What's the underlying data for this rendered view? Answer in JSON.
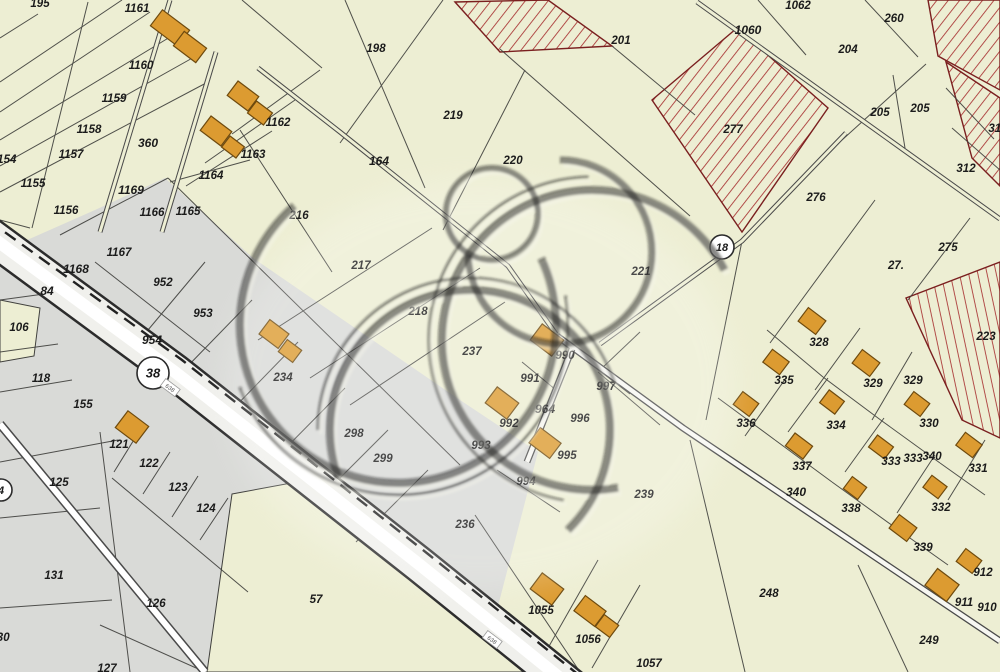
{
  "meta": {
    "kind": "cadastral-parcel-map",
    "width": 1000,
    "height": 672
  },
  "colors": {
    "background": "#edeed3",
    "gray_zone": "#d9dad7",
    "parcel_line": "#3f3f3c",
    "building_fill": "#dc9b31",
    "building_stroke": "#6e4a0e",
    "hatch_line": "#a83232",
    "hatch_border": "#7a1f1f",
    "road_fill": "#f0f0ec",
    "road_edge": "#2c2c2c",
    "road_center": "#ffffff",
    "label": "#1b1b1b",
    "badge_fill": "#ffffff",
    "badge_stroke": "#2b2b2b",
    "watermark": "#1c1c1c"
  },
  "badges": [
    {
      "t": "38",
      "x": 153,
      "y": 373,
      "r": 16
    },
    {
      "t": "18",
      "x": 722,
      "y": 247,
      "r": 12
    },
    {
      "t": "4",
      "x": 1,
      "y": 490,
      "r": 11
    }
  ],
  "road_tags": [
    {
      "t": "638",
      "x": 170,
      "y": 388
    },
    {
      "t": "638",
      "x": 492,
      "y": 640
    }
  ],
  "labels": [
    {
      "t": "195",
      "x": 40,
      "y": 4
    },
    {
      "t": "1161",
      "x": 137,
      "y": 9
    },
    {
      "t": "1160",
      "x": 141,
      "y": 66
    },
    {
      "t": "1159",
      "x": 114,
      "y": 99
    },
    {
      "t": "1158",
      "x": 89,
      "y": 130
    },
    {
      "t": "1157",
      "x": 71,
      "y": 155
    },
    {
      "t": "1154",
      "x": 4,
      "y": 160
    },
    {
      "t": "1155",
      "x": 33,
      "y": 184
    },
    {
      "t": "1156",
      "x": 66,
      "y": 211
    },
    {
      "t": "360",
      "x": 148,
      "y": 144,
      "b": 1
    },
    {
      "t": "1162",
      "x": 278,
      "y": 123
    },
    {
      "t": "1163",
      "x": 253,
      "y": 155
    },
    {
      "t": "1164",
      "x": 211,
      "y": 176
    },
    {
      "t": "1169",
      "x": 131,
      "y": 191,
      "b": 1
    },
    {
      "t": "1166",
      "x": 152,
      "y": 213
    },
    {
      "t": "1165",
      "x": 188,
      "y": 212
    },
    {
      "t": "1167",
      "x": 119,
      "y": 253
    },
    {
      "t": "1168",
      "x": 76,
      "y": 270,
      "b": 1
    },
    {
      "t": "84",
      "x": 47,
      "y": 292,
      "b": 1
    },
    {
      "t": "952",
      "x": 163,
      "y": 283
    },
    {
      "t": "953",
      "x": 203,
      "y": 314
    },
    {
      "t": "954",
      "x": 152,
      "y": 341,
      "b": 1
    },
    {
      "t": "106",
      "x": 19,
      "y": 328
    },
    {
      "t": "118",
      "x": 41,
      "y": 379
    },
    {
      "t": "155",
      "x": 83,
      "y": 405
    },
    {
      "t": "121",
      "x": 119,
      "y": 445
    },
    {
      "t": "122",
      "x": 149,
      "y": 464
    },
    {
      "t": "125",
      "x": 59,
      "y": 483
    },
    {
      "t": "123",
      "x": 178,
      "y": 488
    },
    {
      "t": "124",
      "x": 206,
      "y": 509
    },
    {
      "t": "131",
      "x": 54,
      "y": 576
    },
    {
      "t": "126",
      "x": 156,
      "y": 604
    },
    {
      "t": "127",
      "x": 107,
      "y": 669
    },
    {
      "t": "130",
      "x": 0,
      "y": 638
    },
    {
      "t": "57",
      "x": 316,
      "y": 600
    },
    {
      "t": "198",
      "x": 376,
      "y": 49
    },
    {
      "t": "201",
      "x": 621,
      "y": 41
    },
    {
      "t": "219",
      "x": 453,
      "y": 116
    },
    {
      "t": "220",
      "x": 513,
      "y": 161
    },
    {
      "t": "164",
      "x": 379,
      "y": 162,
      "b": 1
    },
    {
      "t": "216",
      "x": 299,
      "y": 216
    },
    {
      "t": "217",
      "x": 361,
      "y": 266
    },
    {
      "t": "218",
      "x": 418,
      "y": 312
    },
    {
      "t": "237",
      "x": 472,
      "y": 352
    },
    {
      "t": "221",
      "x": 641,
      "y": 272
    },
    {
      "t": "1062",
      "x": 798,
      "y": 6
    },
    {
      "t": "260",
      "x": 894,
      "y": 19
    },
    {
      "t": "1060",
      "x": 748,
      "y": 31,
      "b": 1
    },
    {
      "t": "204",
      "x": 848,
      "y": 50
    },
    {
      "t": "205",
      "x": 880,
      "y": 113
    },
    {
      "t": "205",
      "x": 920,
      "y": 109
    },
    {
      "t": "277",
      "x": 733,
      "y": 130
    },
    {
      "t": "276",
      "x": 816,
      "y": 198
    },
    {
      "t": "312",
      "x": 966,
      "y": 169
    },
    {
      "t": "313",
      "x": 998,
      "y": 129
    },
    {
      "t": "275",
      "x": 948,
      "y": 248
    },
    {
      "t": "27.",
      "x": 896,
      "y": 266
    },
    {
      "t": "223",
      "x": 986,
      "y": 337
    },
    {
      "t": "328",
      "x": 819,
      "y": 343
    },
    {
      "t": "335",
      "x": 784,
      "y": 381
    },
    {
      "t": "329",
      "x": 873,
      "y": 384
    },
    {
      "t": "329",
      "x": 913,
      "y": 381
    },
    {
      "t": "336",
      "x": 746,
      "y": 424
    },
    {
      "t": "334",
      "x": 836,
      "y": 426
    },
    {
      "t": "330",
      "x": 929,
      "y": 424
    },
    {
      "t": "337",
      "x": 802,
      "y": 467
    },
    {
      "t": "333",
      "x": 891,
      "y": 462
    },
    {
      "t": "333",
      "x": 913,
      "y": 459
    },
    {
      "t": "340",
      "x": 932,
      "y": 457
    },
    {
      "t": "331",
      "x": 978,
      "y": 469
    },
    {
      "t": "338",
      "x": 851,
      "y": 509
    },
    {
      "t": "332",
      "x": 941,
      "y": 508
    },
    {
      "t": "339",
      "x": 923,
      "y": 548
    },
    {
      "t": "912",
      "x": 983,
      "y": 573
    },
    {
      "t": "911",
      "x": 964,
      "y": 603
    },
    {
      "t": "910",
      "x": 987,
      "y": 608
    },
    {
      "t": "340",
      "x": 796,
      "y": 493,
      "b": 1
    },
    {
      "t": "248",
      "x": 769,
      "y": 594
    },
    {
      "t": "249",
      "x": 929,
      "y": 641
    },
    {
      "t": "239",
      "x": 644,
      "y": 495
    },
    {
      "t": "236",
      "x": 465,
      "y": 525
    },
    {
      "t": "298",
      "x": 354,
      "y": 434
    },
    {
      "t": "299",
      "x": 383,
      "y": 459
    },
    {
      "t": "990",
      "x": 565,
      "y": 356
    },
    {
      "t": "991",
      "x": 530,
      "y": 379
    },
    {
      "t": "997",
      "x": 606,
      "y": 387
    },
    {
      "t": "992",
      "x": 509,
      "y": 424
    },
    {
      "t": "964",
      "x": 545,
      "y": 410,
      "b": 1
    },
    {
      "t": "996",
      "x": 580,
      "y": 419
    },
    {
      "t": "993",
      "x": 481,
      "y": 446
    },
    {
      "t": "995",
      "x": 567,
      "y": 456
    },
    {
      "t": "994",
      "x": 526,
      "y": 482
    },
    {
      "t": "1055",
      "x": 541,
      "y": 611
    },
    {
      "t": "1056",
      "x": 588,
      "y": 640
    },
    {
      "t": "1057",
      "x": 649,
      "y": 664
    },
    {
      "t": "234",
      "x": 283,
      "y": 378
    }
  ],
  "buildings": [
    {
      "x": 170,
      "y": 28,
      "w": 34,
      "h": 20
    },
    {
      "x": 190,
      "y": 47,
      "w": 28,
      "h": 18
    },
    {
      "x": 243,
      "y": 96,
      "w": 26,
      "h": 18
    },
    {
      "x": 260,
      "y": 113,
      "w": 20,
      "h": 15
    },
    {
      "x": 216,
      "y": 131,
      "w": 26,
      "h": 18
    },
    {
      "x": 233,
      "y": 147,
      "w": 18,
      "h": 14
    },
    {
      "x": 132,
      "y": 427,
      "w": 26,
      "h": 21
    },
    {
      "x": 274,
      "y": 334,
      "w": 24,
      "h": 18
    },
    {
      "x": 290,
      "y": 351,
      "w": 18,
      "h": 15
    },
    {
      "x": 547,
      "y": 340,
      "w": 27,
      "h": 20
    },
    {
      "x": 502,
      "y": 403,
      "w": 27,
      "h": 20
    },
    {
      "x": 545,
      "y": 443,
      "w": 26,
      "h": 19
    },
    {
      "x": 547,
      "y": 589,
      "w": 27,
      "h": 20
    },
    {
      "x": 590,
      "y": 611,
      "w": 26,
      "h": 19
    },
    {
      "x": 607,
      "y": 626,
      "w": 18,
      "h": 15
    },
    {
      "x": 812,
      "y": 321,
      "w": 22,
      "h": 17
    },
    {
      "x": 776,
      "y": 362,
      "w": 21,
      "h": 16
    },
    {
      "x": 866,
      "y": 363,
      "w": 22,
      "h": 17
    },
    {
      "x": 746,
      "y": 404,
      "w": 20,
      "h": 16
    },
    {
      "x": 832,
      "y": 402,
      "w": 19,
      "h": 16
    },
    {
      "x": 917,
      "y": 404,
      "w": 20,
      "h": 16
    },
    {
      "x": 799,
      "y": 446,
      "w": 22,
      "h": 16
    },
    {
      "x": 881,
      "y": 447,
      "w": 20,
      "h": 15
    },
    {
      "x": 969,
      "y": 445,
      "w": 21,
      "h": 16
    },
    {
      "x": 855,
      "y": 488,
      "w": 18,
      "h": 15
    },
    {
      "x": 935,
      "y": 487,
      "w": 19,
      "h": 15
    },
    {
      "x": 903,
      "y": 528,
      "w": 22,
      "h": 17
    },
    {
      "x": 969,
      "y": 561,
      "w": 20,
      "h": 16
    },
    {
      "x": 942,
      "y": 585,
      "w": 27,
      "h": 21
    }
  ],
  "building_angle": 37,
  "hatched_parcels": [
    {
      "pts": "455,2 548,0 612,46 500,52",
      "p": "hatchA"
    },
    {
      "pts": "652,100 737,28 828,108 742,232",
      "p": "hatchA"
    },
    {
      "pts": "928,0 1000,0 1000,90 938,56",
      "p": "hatchA"
    },
    {
      "pts": "946,62 1000,98 1000,186 972,158",
      "p": "hatchA"
    },
    {
      "pts": "906,298 1000,262 1000,438 962,420",
      "p": "hatchB"
    }
  ],
  "gray_zones": [
    {
      "pts": "165,178 253,258 460,400 538,452 497,610 483,672 0,672 0,252 95,210"
    }
  ],
  "yellow_pockets": [
    {
      "pts": "0,300 40,308 34,356 0,362"
    },
    {
      "pts": "232,494 302,481 548,672 207,672"
    }
  ],
  "boundaries": [
    "443,0 340,143",
    "500,49 690,216",
    "525,70 443,230",
    "612,46 695,115",
    "865,0 918,57",
    "758,0 806,55",
    "926,64 842,140",
    "893,75 905,148",
    "946,88 994,139",
    "952,128 1000,170",
    "875,200 770,343",
    "908,300 970,218",
    "345,0 425,188",
    "240,130 332,272",
    "432,228 258,340",
    "480,268 310,378",
    "505,302 350,405",
    "168,178 460,465",
    "60,235 168,178",
    "95,262 210,352",
    "205,262 148,330",
    "252,300 182,372",
    "298,342 228,414",
    "345,388 272,462",
    "388,430 316,502",
    "428,470 356,542",
    "100,432 130,672",
    "0,462 118,440",
    "0,518 100,508",
    "0,608 112,600",
    "0,392 72,380",
    "0,352 58,344",
    "0,300 44,294",
    "112,478 248,592",
    "100,625 205,672",
    "140,430 114,472",
    "170,452 143,494",
    "198,476 172,517",
    "228,498 200,540",
    "690,440 745,672",
    "858,565 908,672",
    "475,515 580,672",
    "598,560 548,648",
    "640,585 592,668",
    "767,330 823,377",
    "823,377 882,421",
    "882,421 940,463",
    "940,463 985,495",
    "860,328 815,390",
    "912,352 872,420",
    "828,378 788,432",
    "884,418 845,472",
    "935,455 897,513",
    "985,440 948,500",
    "786,378 745,436",
    "718,398 775,440",
    "775,440 832,482",
    "832,482 893,526",
    "893,526 948,565",
    "598,372 660,425",
    "497,470 560,512",
    "522,362 556,390",
    "640,332 600,370",
    "38,14 0,38",
    "122,0 0,82",
    "150,12 0,112",
    "175,34 0,140",
    "196,56 0,166",
    "208,82 0,192",
    "88,2 32,228",
    "30,228 0,220",
    "295,100 205,163",
    "272,131 186,186",
    "250,160 170,182",
    "320,70 232,134",
    "242,0 322,68",
    "0,258 36,254",
    "575,352 630,394",
    "742,241 706,420"
  ],
  "roads": {
    "main_path": "M -15,232 L 175,372 L 420,565 L 575,690",
    "main_edge_dash": "M -12,220 L 182,360 L 428,554 L 585,680",
    "side_lane": "M 0,424 L 205,672",
    "double_lanes": [
      {
        "d": "M 697,2 L 1000,219",
        "w": "n"
      },
      {
        "d": "M 557,336 L 683,428 L 1000,641",
        "w": "w"
      },
      {
        "d": "M 846,133 L 742,241 L 600,344",
        "w": "n"
      },
      {
        "d": "M 572,349 L 527,462",
        "w": "w"
      },
      {
        "d": "M 258,68 L 340,132 L 508,266 L 556,334",
        "w": "n"
      },
      {
        "d": "M 170,0 L 100,232",
        "w": "n"
      },
      {
        "d": "M 216,52 L 162,232",
        "w": "n"
      }
    ]
  },
  "watermark": {
    "glow": {
      "cx": 480,
      "cy": 385,
      "rx": 255,
      "ry": 205
    },
    "rings": [
      {
        "cx": 398,
        "cy": 325,
        "r": 158,
        "w": 8,
        "dash": "700 293",
        "rot": -25
      },
      {
        "cx": 592,
        "cy": 340,
        "r": 150,
        "w": 8,
        "dash": "660 282",
        "rot": 80
      },
      {
        "cx": 470,
        "cy": 430,
        "r": 140,
        "w": 8,
        "dash": "600 280",
        "rot": 160
      },
      {
        "cx": 560,
        "cy": 252,
        "r": 92,
        "w": 7,
        "dash": "430 148",
        "rot": -90
      },
      {
        "cx": 492,
        "cy": 214,
        "r": 46,
        "w": 6,
        "dash": "",
        "rot": 0
      },
      {
        "cx": 398,
        "cy": 325,
        "r": 170,
        "w": 3,
        "dash": "500 570",
        "rot": -10
      },
      {
        "cx": 592,
        "cy": 340,
        "r": 163,
        "w": 3,
        "dash": "480 544",
        "rot": 100
      },
      {
        "cx": 470,
        "cy": 430,
        "r": 152,
        "w": 3,
        "dash": "430 526",
        "rot": 180
      }
    ]
  }
}
